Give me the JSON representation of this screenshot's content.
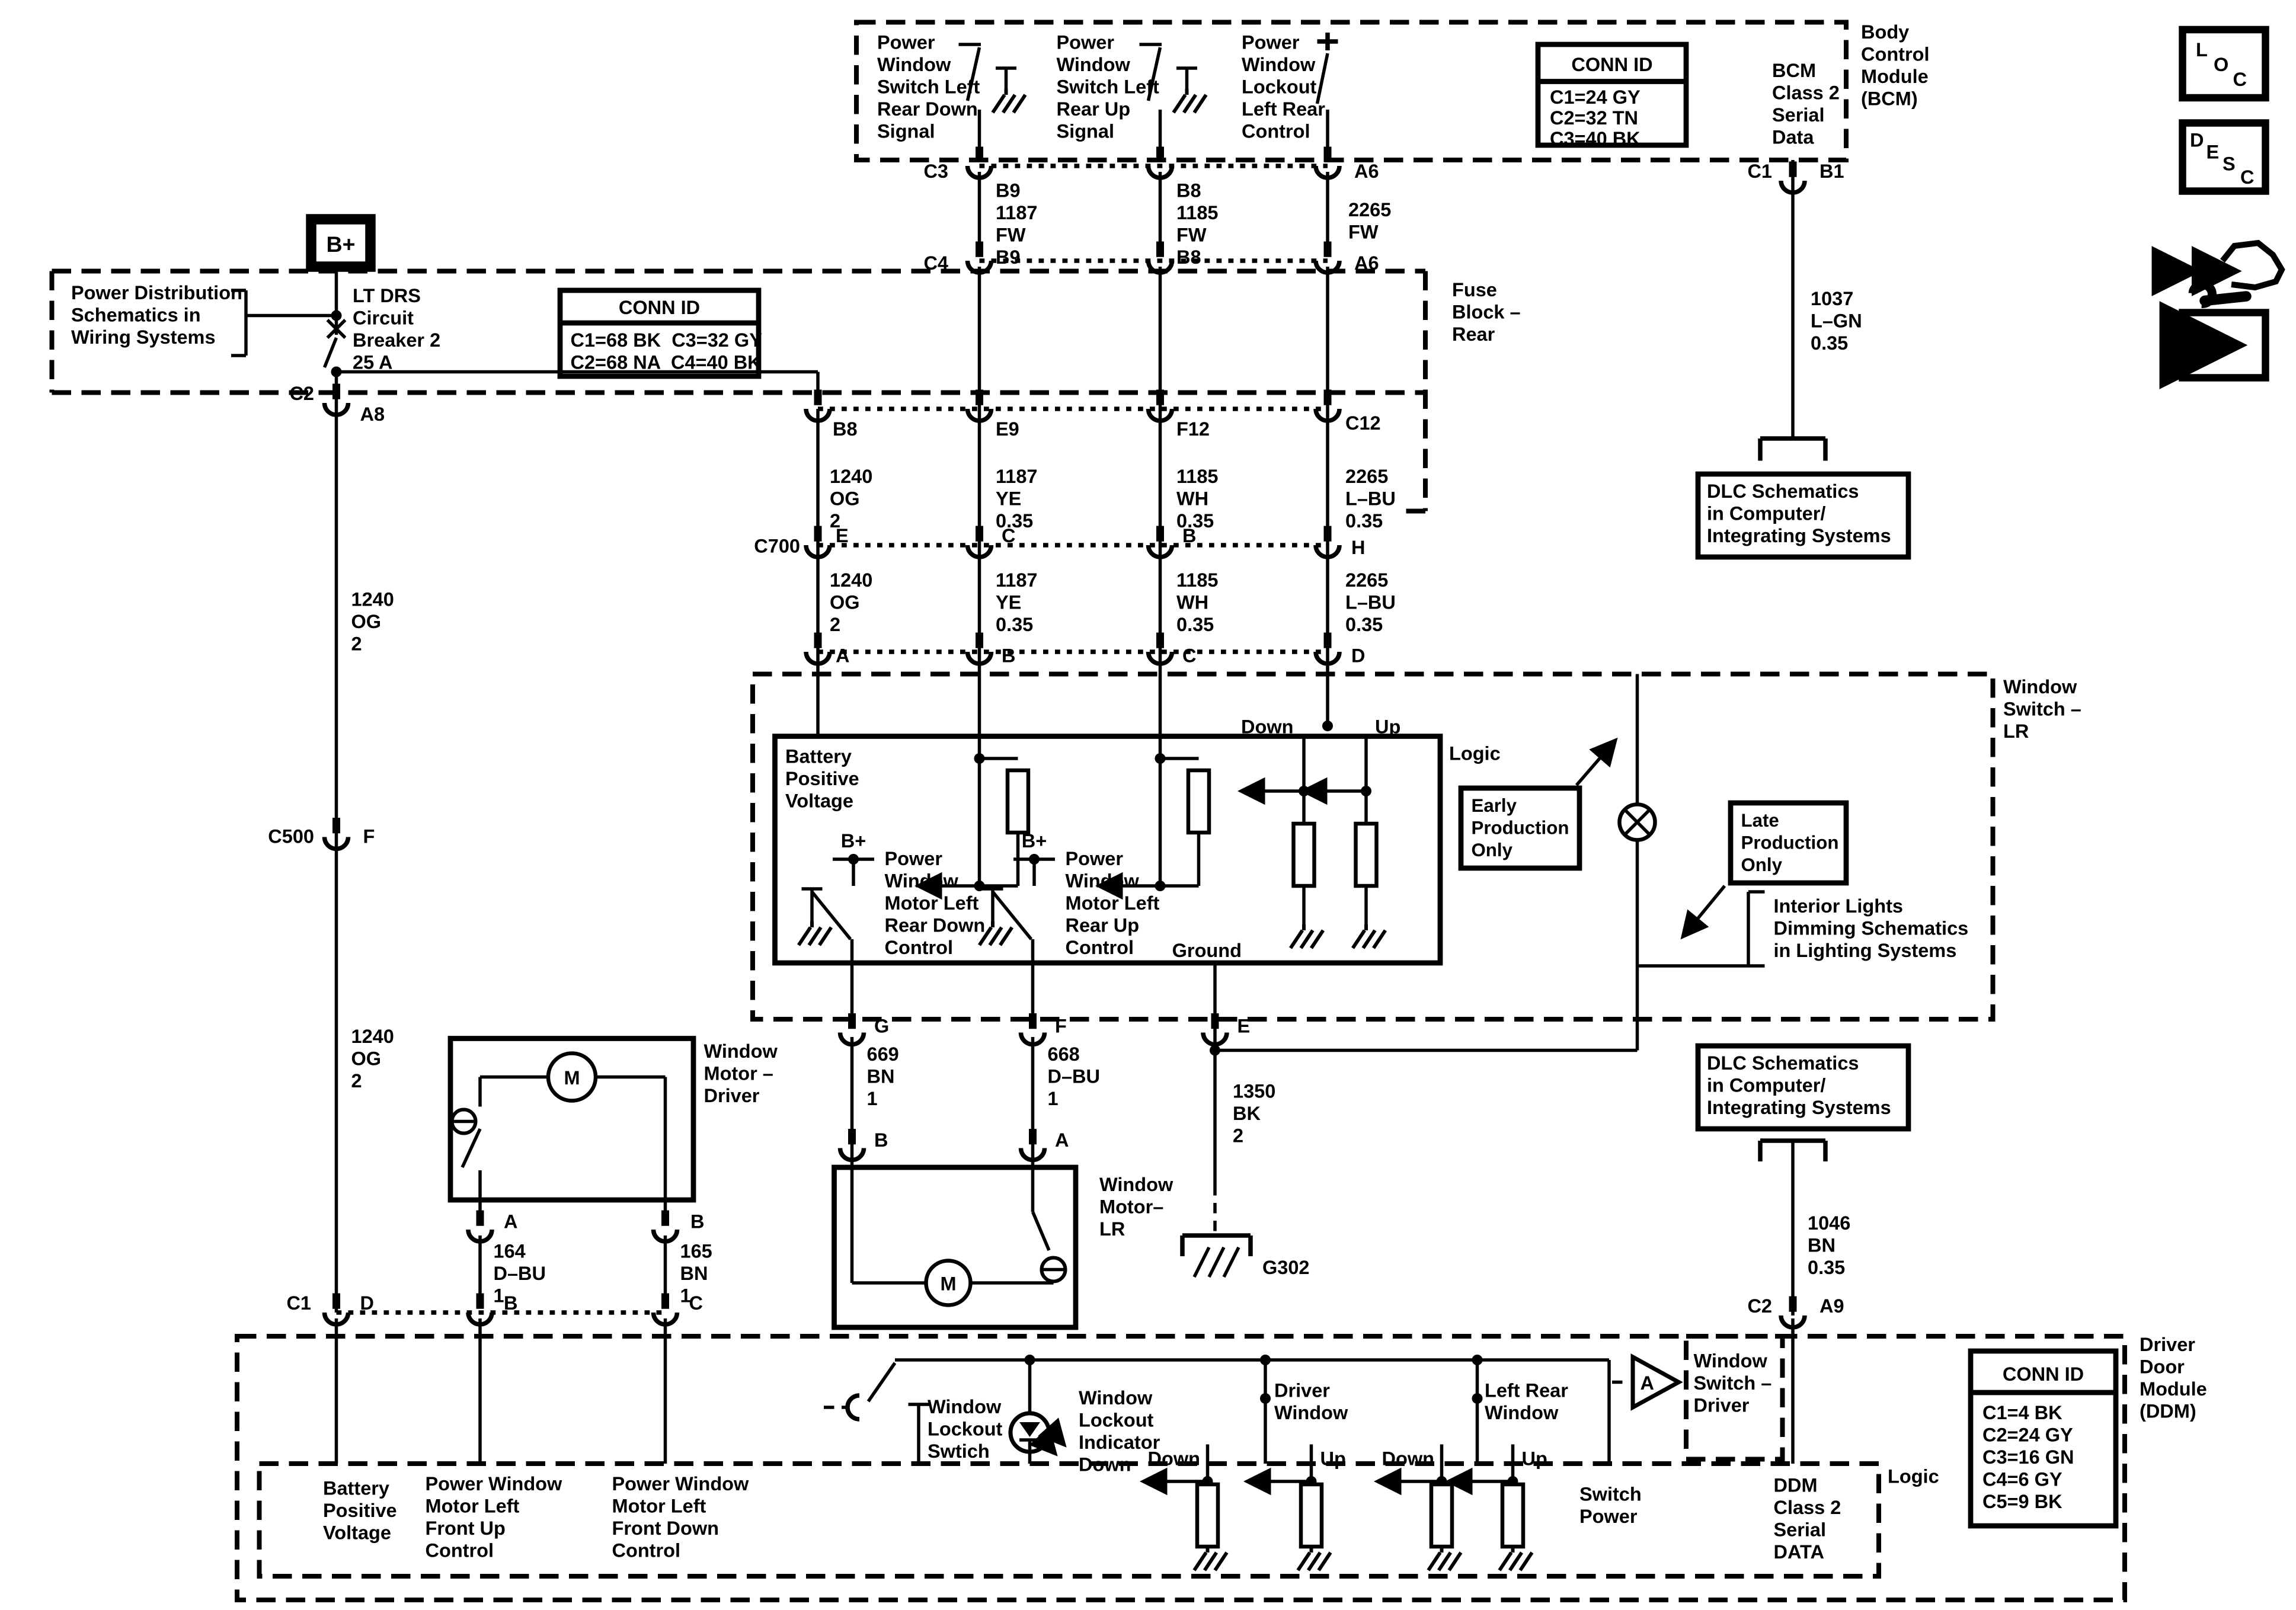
{
  "accent_color": "#000000",
  "background_color": "#ffffff",
  "labels": {
    "b_plus": "B+",
    "c2": "C2",
    "a8": "A8",
    "c500": "C500",
    "f_pin": "F",
    "c1_bot": "C1",
    "d_bot": "D",
    "b_bot": "B",
    "c_bot": "C",
    "c3": "C3",
    "a6_top": "A6",
    "c4": "C4",
    "a6_mid": "A6",
    "b8": "B8",
    "e9": "E9",
    "f12": "F12",
    "c12": "C12",
    "c700": "C700",
    "pin_e": "E",
    "pin_c": "C",
    "pin_b": "B",
    "pin_h": "H",
    "pin_a2": "A",
    "pin_b2": "B",
    "pin_c2": "C",
    "pin_d2": "D",
    "c1_bcm": "C1",
    "b1": "B1",
    "logic1": "Logic",
    "logic2": "Logic",
    "down1": "Down",
    "up1": "Up",
    "bplus_sw1": "B+",
    "bplus_sw2": "B+",
    "ground": "Ground",
    "g_pin": "G",
    "f2_pin": "F",
    "e2_pin": "E",
    "b3_pin": "B",
    "a3_pin": "A",
    "g302": "G302",
    "a_mot": "A",
    "b_mot": "B",
    "down_a": "Down",
    "up_a": "Up",
    "down_b": "Down",
    "up_b": "Up",
    "tri_a": "A",
    "c2_ddm": "C2",
    "a9": "A9"
  },
  "stacks": {
    "pd": [
      "Power Distribution",
      "Schematics in",
      "Wiring Systems"
    ],
    "breaker": [
      "LT DRS",
      "Circuit",
      "Breaker 2",
      "25 A"
    ],
    "fuse": [
      "Fuse",
      "Block –",
      "Rear"
    ],
    "sw1": [
      "Power",
      "Window",
      "Switch Left",
      "Rear Down",
      "Signal"
    ],
    "sw2": [
      "Power",
      "Window",
      "Switch Left",
      "Rear Up",
      "Signal"
    ],
    "sw3": [
      "Power",
      "Window",
      "Lockout",
      "Left Rear",
      "Control"
    ],
    "bcm_serial": [
      "BCM",
      "Class 2",
      "Serial",
      "Data"
    ],
    "bcm_module": [
      "Body",
      "Control",
      "Module",
      "(BCM)"
    ],
    "w1037": [
      "1037",
      "L–GN",
      "0.35"
    ],
    "dlc": [
      "DLC Schematics",
      "in Computer/",
      "Integrating Systems"
    ],
    "dlc2": [
      "DLC Schematics",
      "in Computer/",
      "Integrating Systems"
    ],
    "w1187top": [
      "B9",
      "1187",
      "FW",
      "B9"
    ],
    "w1185top": [
      "B8",
      "1185",
      "FW",
      "B8"
    ],
    "w2265top": [
      "2265",
      "FW"
    ],
    "w1240a": [
      "1240",
      "OG",
      "2"
    ],
    "w1187m": [
      "1187",
      "YE",
      "0.35"
    ],
    "w1185m": [
      "1185",
      "WH",
      "0.35"
    ],
    "w2265m": [
      "2265",
      "L–BU",
      "0.35"
    ],
    "w1240b": [
      "1240",
      "OG",
      "2"
    ],
    "w1187b": [
      "1187",
      "YE",
      "0.35"
    ],
    "w1185b": [
      "1185",
      "WH",
      "0.35"
    ],
    "w2265b": [
      "2265",
      "L–BU",
      "0.35"
    ],
    "w1240L1": [
      "1240",
      "OG",
      "2"
    ],
    "w1240L2": [
      "1240",
      "OG",
      "2"
    ],
    "ws_lr": [
      "Window",
      "Switch –",
      "LR"
    ],
    "batt": [
      "Battery",
      "Positive",
      "Voltage"
    ],
    "mctl1": [
      "Power",
      "Window",
      "Motor Left",
      "Rear Down",
      "Control"
    ],
    "mctl2": [
      "Power",
      "Window",
      "Motor Left",
      "Rear Up",
      "Control"
    ],
    "early": [
      "Early",
      "Production",
      "Only"
    ],
    "late": [
      "Late",
      "Production",
      "Only"
    ],
    "interior": [
      "Interior Lights",
      "Dimming Schematics",
      "in Lighting Systems"
    ],
    "w669": [
      "669",
      "BN",
      "1"
    ],
    "w668": [
      "668",
      "D–BU",
      "1"
    ],
    "w1350": [
      "1350",
      "BK",
      "2"
    ],
    "wm_lr": [
      "Window",
      "Motor–",
      "LR"
    ],
    "wm_drv": [
      "Window",
      "Motor –",
      "Driver"
    ],
    "w164": [
      "164",
      "D–BU",
      "1"
    ],
    "w165": [
      "165",
      "BN",
      "1"
    ],
    "ddm": [
      "Driver",
      "Door",
      "Module",
      "(DDM)"
    ],
    "lockout_sw": [
      "Window",
      "Lockout",
      "Swtich"
    ],
    "lockout_ind": [
      "Window",
      "Lockout",
      "Indicator",
      "Down"
    ],
    "drv_win": [
      "Driver",
      "Window"
    ],
    "lr_win": [
      "Left Rear",
      "Window"
    ],
    "sw_pwr": [
      "Switch",
      "Power"
    ],
    "ws_drv": [
      "Window",
      "Switch –",
      "Driver"
    ],
    "ddm_serial": [
      "DDM",
      "Class 2",
      "Serial",
      "DATA"
    ],
    "batt2": [
      "Battery",
      "Positive",
      "Voltage"
    ],
    "pw_fu": [
      "Power Window",
      "Motor Left",
      "Front Up",
      "Control"
    ],
    "pw_fd": [
      "Power Window",
      "Motor Left",
      "Front Down",
      "Control"
    ],
    "w1046": [
      "1046",
      "BN",
      "0.35"
    ]
  },
  "conn_ids": {
    "fuse": {
      "title": "CONN ID",
      "rows": [
        "C1=68 BK  C3=32 GY",
        "C2=68 NA  C4=40 BK"
      ]
    },
    "bcm": {
      "title": "CONN ID",
      "rows": [
        "C1=24 GY",
        "C2=32 TN",
        "C3=40 BK"
      ]
    },
    "ddm": {
      "title": "CONN ID",
      "rows": [
        "C1=4 BK",
        "C2=24 GY",
        "C3=16 GN",
        "C4=6 GY",
        "C5=9 BK"
      ]
    }
  },
  "icons": {
    "loc": [
      "L",
      "O",
      "C"
    ],
    "desc": [
      "D",
      "E",
      "S",
      "C"
    ]
  }
}
